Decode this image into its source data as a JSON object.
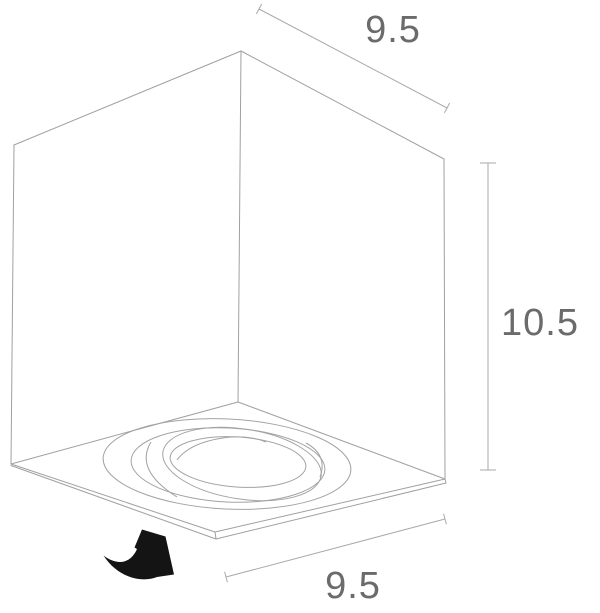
{
  "diagram": {
    "type": "technical-dimension-drawing",
    "subject": "cube-shaped-spotlight-luminaire-isometric-view",
    "dimensions": {
      "top_width": "9.5",
      "side_height": "10.5",
      "bottom_depth": "9.5"
    },
    "icons": {
      "rotate_arrow": "rotate-arrow-icon"
    },
    "colors": {
      "outline": "#a0a0a0",
      "dimension_line": "#aaaaaa",
      "label_text": "#6b6b6b",
      "arrow": "#141414",
      "background": "#ffffff"
    }
  }
}
